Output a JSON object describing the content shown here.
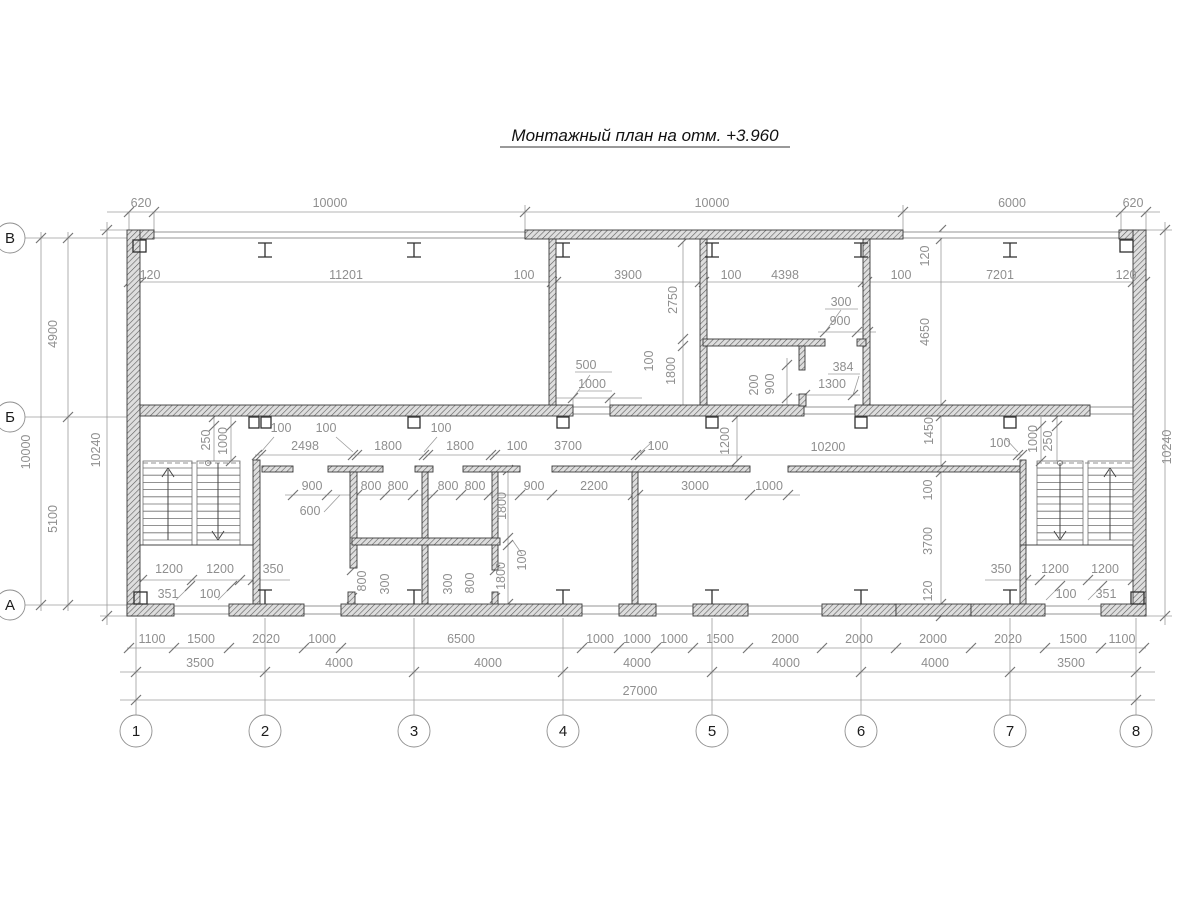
{
  "title": {
    "text": "Монтажный план на отм. +3.960"
  },
  "colors": {
    "dim_text": "#8f8f8f",
    "wall_line": "#3a3a3a",
    "thin_line": "#9c9c9c",
    "axis_text": "#1c1c1c"
  },
  "axis_circles": {
    "columns_y": 731,
    "columns_r": 16,
    "columns": [
      {
        "label": "1",
        "x": 136
      },
      {
        "label": "2",
        "x": 265
      },
      {
        "label": "3",
        "x": 414
      },
      {
        "label": "4",
        "x": 563
      },
      {
        "label": "5",
        "x": 712
      },
      {
        "label": "6",
        "x": 861
      },
      {
        "label": "7",
        "x": 1010
      },
      {
        "label": "8",
        "x": 1136
      }
    ],
    "rows_x": 10,
    "rows_r": 15,
    "rows": [
      {
        "label": "В",
        "y": 238
      },
      {
        "label": "Б",
        "y": 417
      },
      {
        "label": "А",
        "y": 605
      }
    ]
  },
  "labels": [
    {
      "t": "620",
      "x": 141,
      "y": 207
    },
    {
      "t": "10000",
      "x": 330,
      "y": 207
    },
    {
      "t": "10000",
      "x": 712,
      "y": 207
    },
    {
      "t": "6000",
      "x": 1012,
      "y": 207
    },
    {
      "t": "620",
      "x": 1133,
      "y": 207
    },
    {
      "t": "120",
      "x": 150,
      "y": 279
    },
    {
      "t": "11201",
      "x": 346,
      "y": 279
    },
    {
      "t": "100",
      "x": 524,
      "y": 279
    },
    {
      "t": "3900",
      "x": 628,
      "y": 279
    },
    {
      "t": "100",
      "x": 731,
      "y": 279
    },
    {
      "t": "4398",
      "x": 785,
      "y": 279
    },
    {
      "t": "100",
      "x": 901,
      "y": 279
    },
    {
      "t": "7201",
      "x": 1000,
      "y": 279
    },
    {
      "t": "120",
      "x": 1126,
      "y": 279
    },
    {
      "t": "4900",
      "x": 57,
      "y": 334,
      "r": 1
    },
    {
      "t": "10000",
      "x": 30,
      "y": 452,
      "r": 1
    },
    {
      "t": "5100",
      "x": 57,
      "y": 519,
      "r": 1
    },
    {
      "t": "10240",
      "x": 100,
      "y": 450,
      "r": 1
    },
    {
      "t": "10240",
      "x": 1171,
      "y": 447,
      "r": 1
    },
    {
      "t": "120",
      "x": 929,
      "y": 256,
      "r": 1
    },
    {
      "t": "4650",
      "x": 929,
      "y": 332,
      "r": 1
    },
    {
      "t": "1450",
      "x": 933,
      "y": 431,
      "r": 1
    },
    {
      "t": "100",
      "x": 932,
      "y": 490,
      "r": 1
    },
    {
      "t": "3700",
      "x": 932,
      "y": 541,
      "r": 1
    },
    {
      "t": "120",
      "x": 932,
      "y": 591,
      "r": 1
    },
    {
      "t": "2750",
      "x": 677,
      "y": 300,
      "r": 1
    },
    {
      "t": "500",
      "x": 586,
      "y": 369
    },
    {
      "t": "1000",
      "x": 592,
      "y": 388
    },
    {
      "t": "100",
      "x": 653,
      "y": 361,
      "r": 1
    },
    {
      "t": "1800",
      "x": 675,
      "y": 371,
      "r": 1
    },
    {
      "t": "300",
      "x": 841,
      "y": 306
    },
    {
      "t": "900",
      "x": 840,
      "y": 325
    },
    {
      "t": "200",
      "x": 758,
      "y": 385,
      "r": 1
    },
    {
      "t": "900",
      "x": 774,
      "y": 384,
      "r": 1
    },
    {
      "t": "384",
      "x": 843,
      "y": 371
    },
    {
      "t": "1300",
      "x": 832,
      "y": 388
    },
    {
      "t": "250",
      "x": 210,
      "y": 440,
      "r": 1
    },
    {
      "t": "1000",
      "x": 227,
      "y": 441,
      "r": 1
    },
    {
      "t": "100",
      "x": 281,
      "y": 432
    },
    {
      "t": "100",
      "x": 326,
      "y": 432
    },
    {
      "t": "2498",
      "x": 305,
      "y": 450
    },
    {
      "t": "1800",
      "x": 388,
      "y": 450
    },
    {
      "t": "100",
      "x": 441,
      "y": 432
    },
    {
      "t": "1800",
      "x": 460,
      "y": 450
    },
    {
      "t": "100",
      "x": 517,
      "y": 450
    },
    {
      "t": "3700",
      "x": 568,
      "y": 450
    },
    {
      "t": "100",
      "x": 658,
      "y": 450
    },
    {
      "t": "1200",
      "x": 729,
      "y": 441,
      "r": 1
    },
    {
      "t": "10200",
      "x": 828,
      "y": 451
    },
    {
      "t": "100",
      "x": 1000,
      "y": 447
    },
    {
      "t": "1000",
      "x": 1037,
      "y": 439,
      "r": 1
    },
    {
      "t": "250",
      "x": 1052,
      "y": 441,
      "r": 1
    },
    {
      "t": "900",
      "x": 312,
      "y": 490
    },
    {
      "t": "600",
      "x": 310,
      "y": 515
    },
    {
      "t": "800",
      "x": 371,
      "y": 490
    },
    {
      "t": "800",
      "x": 398,
      "y": 490
    },
    {
      "t": "800",
      "x": 448,
      "y": 490
    },
    {
      "t": "800",
      "x": 475,
      "y": 490
    },
    {
      "t": "900",
      "x": 534,
      "y": 490
    },
    {
      "t": "2200",
      "x": 594,
      "y": 490
    },
    {
      "t": "3000",
      "x": 695,
      "y": 490
    },
    {
      "t": "1000",
      "x": 769,
      "y": 490
    },
    {
      "t": "1800",
      "x": 506,
      "y": 506,
      "r": 1
    },
    {
      "t": "100",
      "x": 526,
      "y": 560,
      "r": 1
    },
    {
      "t": "1800",
      "x": 505,
      "y": 576,
      "r": 1
    },
    {
      "t": "800",
      "x": 366,
      "y": 581,
      "r": 1
    },
    {
      "t": "300",
      "x": 389,
      "y": 584,
      "r": 1
    },
    {
      "t": "300",
      "x": 452,
      "y": 584,
      "r": 1
    },
    {
      "t": "800",
      "x": 474,
      "y": 583,
      "r": 1
    },
    {
      "t": "1200",
      "x": 169,
      "y": 573
    },
    {
      "t": "1200",
      "x": 220,
      "y": 573
    },
    {
      "t": "350",
      "x": 273,
      "y": 573
    },
    {
      "t": "351",
      "x": 168,
      "y": 598
    },
    {
      "t": "100",
      "x": 210,
      "y": 598
    },
    {
      "t": "350",
      "x": 1001,
      "y": 573
    },
    {
      "t": "1200",
      "x": 1055,
      "y": 573
    },
    {
      "t": "1200",
      "x": 1105,
      "y": 573
    },
    {
      "t": "100",
      "x": 1066,
      "y": 598
    },
    {
      "t": "351",
      "x": 1106,
      "y": 598
    },
    {
      "t": "1100",
      "x": 152,
      "y": 643
    },
    {
      "t": "1500",
      "x": 201,
      "y": 643
    },
    {
      "t": "2020",
      "x": 266,
      "y": 643
    },
    {
      "t": "1000",
      "x": 322,
      "y": 643
    },
    {
      "t": "6500",
      "x": 461,
      "y": 643
    },
    {
      "t": "1000",
      "x": 600,
      "y": 643
    },
    {
      "t": "1000",
      "x": 637,
      "y": 643
    },
    {
      "t": "1000",
      "x": 674,
      "y": 643
    },
    {
      "t": "1500",
      "x": 720,
      "y": 643
    },
    {
      "t": "2000",
      "x": 785,
      "y": 643
    },
    {
      "t": "2000",
      "x": 859,
      "y": 643
    },
    {
      "t": "2000",
      "x": 933,
      "y": 643
    },
    {
      "t": "2020",
      "x": 1008,
      "y": 643
    },
    {
      "t": "1500",
      "x": 1073,
      "y": 643
    },
    {
      "t": "1100",
      "x": 1122,
      "y": 643
    },
    {
      "t": "3500",
      "x": 200,
      "y": 667
    },
    {
      "t": "4000",
      "x": 339,
      "y": 667
    },
    {
      "t": "4000",
      "x": 488,
      "y": 667
    },
    {
      "t": "4000",
      "x": 637,
      "y": 667
    },
    {
      "t": "4000",
      "x": 786,
      "y": 667
    },
    {
      "t": "4000",
      "x": 935,
      "y": 667
    },
    {
      "t": "3500",
      "x": 1071,
      "y": 667
    },
    {
      "t": "27000",
      "x": 640,
      "y": 695
    }
  ]
}
